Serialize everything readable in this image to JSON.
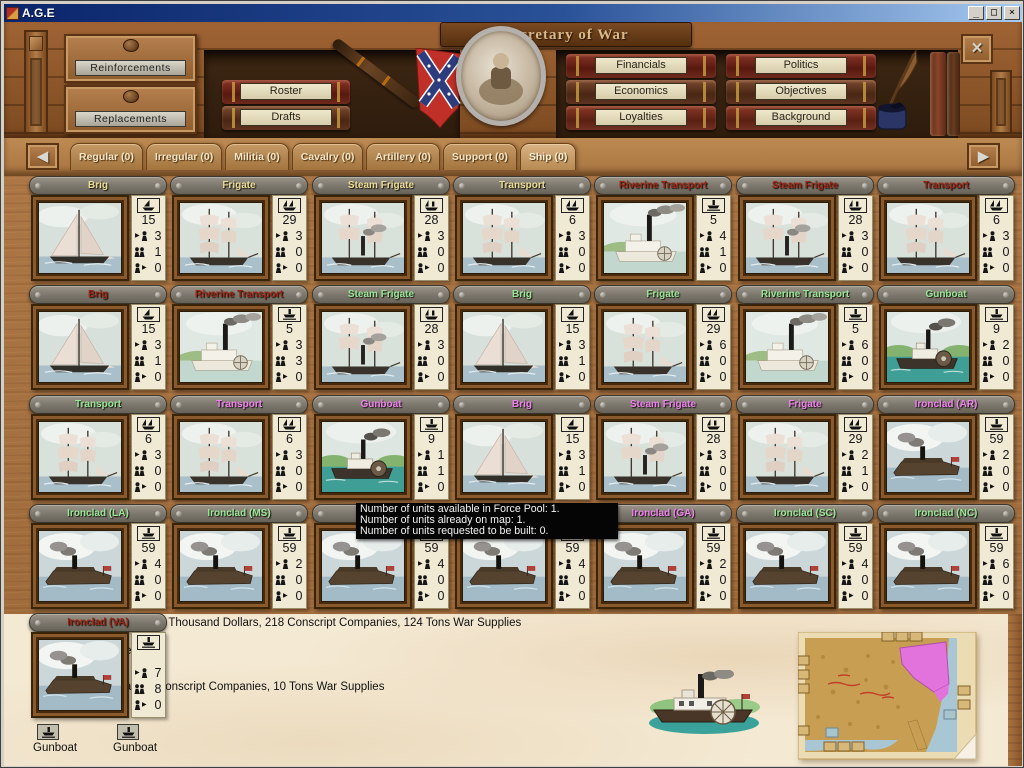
{
  "window": {
    "title": "A.G.E",
    "minimize": "_",
    "maximize": "□",
    "close": "×"
  },
  "shelf": {
    "title": "Secretary of War",
    "drawers": [
      {
        "label": "Reinforcements"
      },
      {
        "label": "Replacements"
      }
    ],
    "left_books": [
      {
        "label": "Roster"
      },
      {
        "label": "Drafts"
      }
    ],
    "right_books_col1": [
      {
        "label": "Financials"
      },
      {
        "label": "Economics"
      },
      {
        "label": "Loyalties"
      }
    ],
    "right_books_col2": [
      {
        "label": "Politics"
      },
      {
        "label": "Objectives"
      },
      {
        "label": "Background"
      }
    ]
  },
  "tabs": {
    "items": [
      {
        "label": "Regular (0)",
        "active": false
      },
      {
        "label": "Irregular (0)",
        "active": false
      },
      {
        "label": "Militia (0)",
        "active": false
      },
      {
        "label": "Cavalry (0)",
        "active": false
      },
      {
        "label": "Artillery (0)",
        "active": false
      },
      {
        "label": "Support (0)",
        "active": false
      },
      {
        "label": "Ship (0)",
        "active": true
      }
    ]
  },
  "force_pool": {
    "cards": [
      {
        "name": "Brig",
        "name_color": "yellow",
        "type_icon": "sail-ship-icon",
        "picture": "brig",
        "count": 15,
        "available": 3,
        "on_map": 1,
        "requested": 0
      },
      {
        "name": "Frigate",
        "name_color": "yellow",
        "type_icon": "full-rigged-ship-icon",
        "picture": "tallship",
        "count": 29,
        "available": 3,
        "on_map": 0,
        "requested": 0
      },
      {
        "name": "Steam Frigate",
        "name_color": "yellow",
        "type_icon": "steam-sail-ship-icon",
        "picture": "steamfrigate",
        "count": 28,
        "available": 3,
        "on_map": 0,
        "requested": 0
      },
      {
        "name": "Transport",
        "name_color": "yellow",
        "type_icon": "full-rigged-ship-icon",
        "picture": "tallship",
        "count": 6,
        "available": 3,
        "on_map": 0,
        "requested": 0
      },
      {
        "name": "Riverine Transport",
        "name_color": "red",
        "type_icon": "steam-ship-icon",
        "picture": "riversteam",
        "count": 5,
        "available": 4,
        "on_map": 1,
        "requested": 0
      },
      {
        "name": "Steam Frigate",
        "name_color": "red",
        "type_icon": "steam-sail-ship-icon",
        "picture": "steamfrigate",
        "count": 28,
        "available": 3,
        "on_map": 0,
        "requested": 0
      },
      {
        "name": "Transport",
        "name_color": "red",
        "type_icon": "full-rigged-ship-icon",
        "picture": "tallship",
        "count": 6,
        "available": 3,
        "on_map": 0,
        "requested": 0
      },
      {
        "name": "Brig",
        "name_color": "red",
        "type_icon": "sail-ship-icon",
        "picture": "brig",
        "count": 15,
        "available": 3,
        "on_map": 1,
        "requested": 0
      },
      {
        "name": "Riverine Transport",
        "name_color": "red",
        "type_icon": "steam-ship-icon",
        "picture": "riversteam",
        "count": 5,
        "available": 3,
        "on_map": 3,
        "requested": 0
      },
      {
        "name": "Steam Frigate",
        "name_color": "green",
        "type_icon": "steam-sail-ship-icon",
        "picture": "steamfrigate",
        "count": 28,
        "available": 3,
        "on_map": 0,
        "requested": 0
      },
      {
        "name": "Brig",
        "name_color": "green",
        "type_icon": "sail-ship-icon",
        "picture": "brig",
        "count": 15,
        "available": 3,
        "on_map": 1,
        "requested": 0
      },
      {
        "name": "Frigate",
        "name_color": "green",
        "type_icon": "full-rigged-ship-icon",
        "picture": "tallship",
        "count": 29,
        "available": 6,
        "on_map": 0,
        "requested": 0
      },
      {
        "name": "Riverine Transport",
        "name_color": "green",
        "type_icon": "steam-ship-icon",
        "picture": "riversteam",
        "count": 5,
        "available": 6,
        "on_map": 0,
        "requested": 0
      },
      {
        "name": "Gunboat",
        "name_color": "green",
        "type_icon": "steam-ship-icon",
        "picture": "gunboat",
        "count": 9,
        "available": 2,
        "on_map": 0,
        "requested": 0
      },
      {
        "name": "Transport",
        "name_color": "green",
        "type_icon": "full-rigged-ship-icon",
        "picture": "tallship",
        "count": 6,
        "available": 3,
        "on_map": 0,
        "requested": 0
      },
      {
        "name": "Transport",
        "name_color": "magenta",
        "type_icon": "full-rigged-ship-icon",
        "picture": "tallship",
        "count": 6,
        "available": 3,
        "on_map": 0,
        "requested": 0
      },
      {
        "name": "Gunboat",
        "name_color": "magenta",
        "type_icon": "steam-ship-icon",
        "picture": "gunboat",
        "count": 9,
        "available": 1,
        "on_map": 1,
        "requested": 0
      },
      {
        "name": "Brig",
        "name_color": "magenta",
        "type_icon": "sail-ship-icon",
        "picture": "brig",
        "count": 15,
        "available": 3,
        "on_map": 1,
        "requested": 0
      },
      {
        "name": "Steam Frigate",
        "name_color": "magenta",
        "type_icon": "steam-sail-ship-icon",
        "picture": "steamfrigate",
        "count": 28,
        "available": 3,
        "on_map": 0,
        "requested": 0
      },
      {
        "name": "Frigate",
        "name_color": "magenta",
        "type_icon": "full-rigged-ship-icon",
        "picture": "tallship",
        "count": 29,
        "available": 2,
        "on_map": 1,
        "requested": 0
      },
      {
        "name": "Ironclad (AR)",
        "name_color": "magenta",
        "type_icon": "steam-ship-icon",
        "picture": "ironclad",
        "count": 59,
        "available": 2,
        "on_map": 0,
        "requested": 0
      },
      {
        "name": "Ironclad (LA)",
        "name_color": "green",
        "type_icon": "steam-ship-icon",
        "picture": "ironclad",
        "count": 59,
        "available": 4,
        "on_map": 0,
        "requested": 0
      },
      {
        "name": "Ironclad (MS)",
        "name_color": "green",
        "type_icon": "steam-ship-icon",
        "picture": "ironclad",
        "count": 59,
        "available": 2,
        "on_map": 0,
        "requested": 0
      },
      {
        "name": "Ironclad",
        "name_color": "green",
        "type_icon": "steam-ship-icon",
        "picture": "ironclad",
        "count": 59,
        "available": 4,
        "on_map": 0,
        "requested": 0
      },
      {
        "name": "Ironclad",
        "name_color": "green",
        "type_icon": "steam-ship-icon",
        "picture": "ironclad",
        "count": 59,
        "available": 4,
        "on_map": 0,
        "requested": 0
      },
      {
        "name": "Ironclad (GA)",
        "name_color": "magenta",
        "type_icon": "steam-ship-icon",
        "picture": "ironclad",
        "count": 59,
        "available": 2,
        "on_map": 0,
        "requested": 0
      },
      {
        "name": "Ironclad (SC)",
        "name_color": "green",
        "type_icon": "steam-ship-icon",
        "picture": "ironclad",
        "count": 59,
        "available": 4,
        "on_map": 0,
        "requested": 0
      },
      {
        "name": "Ironclad (NC)",
        "name_color": "green",
        "type_icon": "steam-ship-icon",
        "picture": "ironclad",
        "count": 59,
        "available": 6,
        "on_map": 0,
        "requested": 0
      }
    ],
    "va_card": {
      "name": "Ironclad (VA)",
      "name_color": "red",
      "type_icon": "steam-ship-icon",
      "picture": "ironclad",
      "count": "",
      "available": 7,
      "on_map": 8,
      "requested": 0
    }
  },
  "tooltip": {
    "lines": [
      "Number of units available in Force Pool: 1.",
      "Number of units already on map: 1.",
      "Number of units requested to be built: 0."
    ]
  },
  "footer": {
    "cost_line": "5 Thousand Dollars, 218 Conscript Companies, 124 Tons War Supplies",
    "unit_line": "Gunboat - 2 Elements:",
    "region": "Mid Atlantic",
    "unit_cost_line": "10 Thousand Dollars, 2 Conscript Companies, 10 Tons War Supplies",
    "elements": [
      {
        "label": "Gunboat"
      },
      {
        "label": "Gunboat"
      }
    ]
  },
  "colors": {
    "titlebar_blue": "#0a246a",
    "name_yellow": "#eadd96",
    "name_red": "#9e2412",
    "name_green": "#98e796",
    "name_magenta": "#ee82ee",
    "region_pink": "#e466d8",
    "tooltip_bg": "#050505",
    "map_highlight": "#e273dc"
  }
}
